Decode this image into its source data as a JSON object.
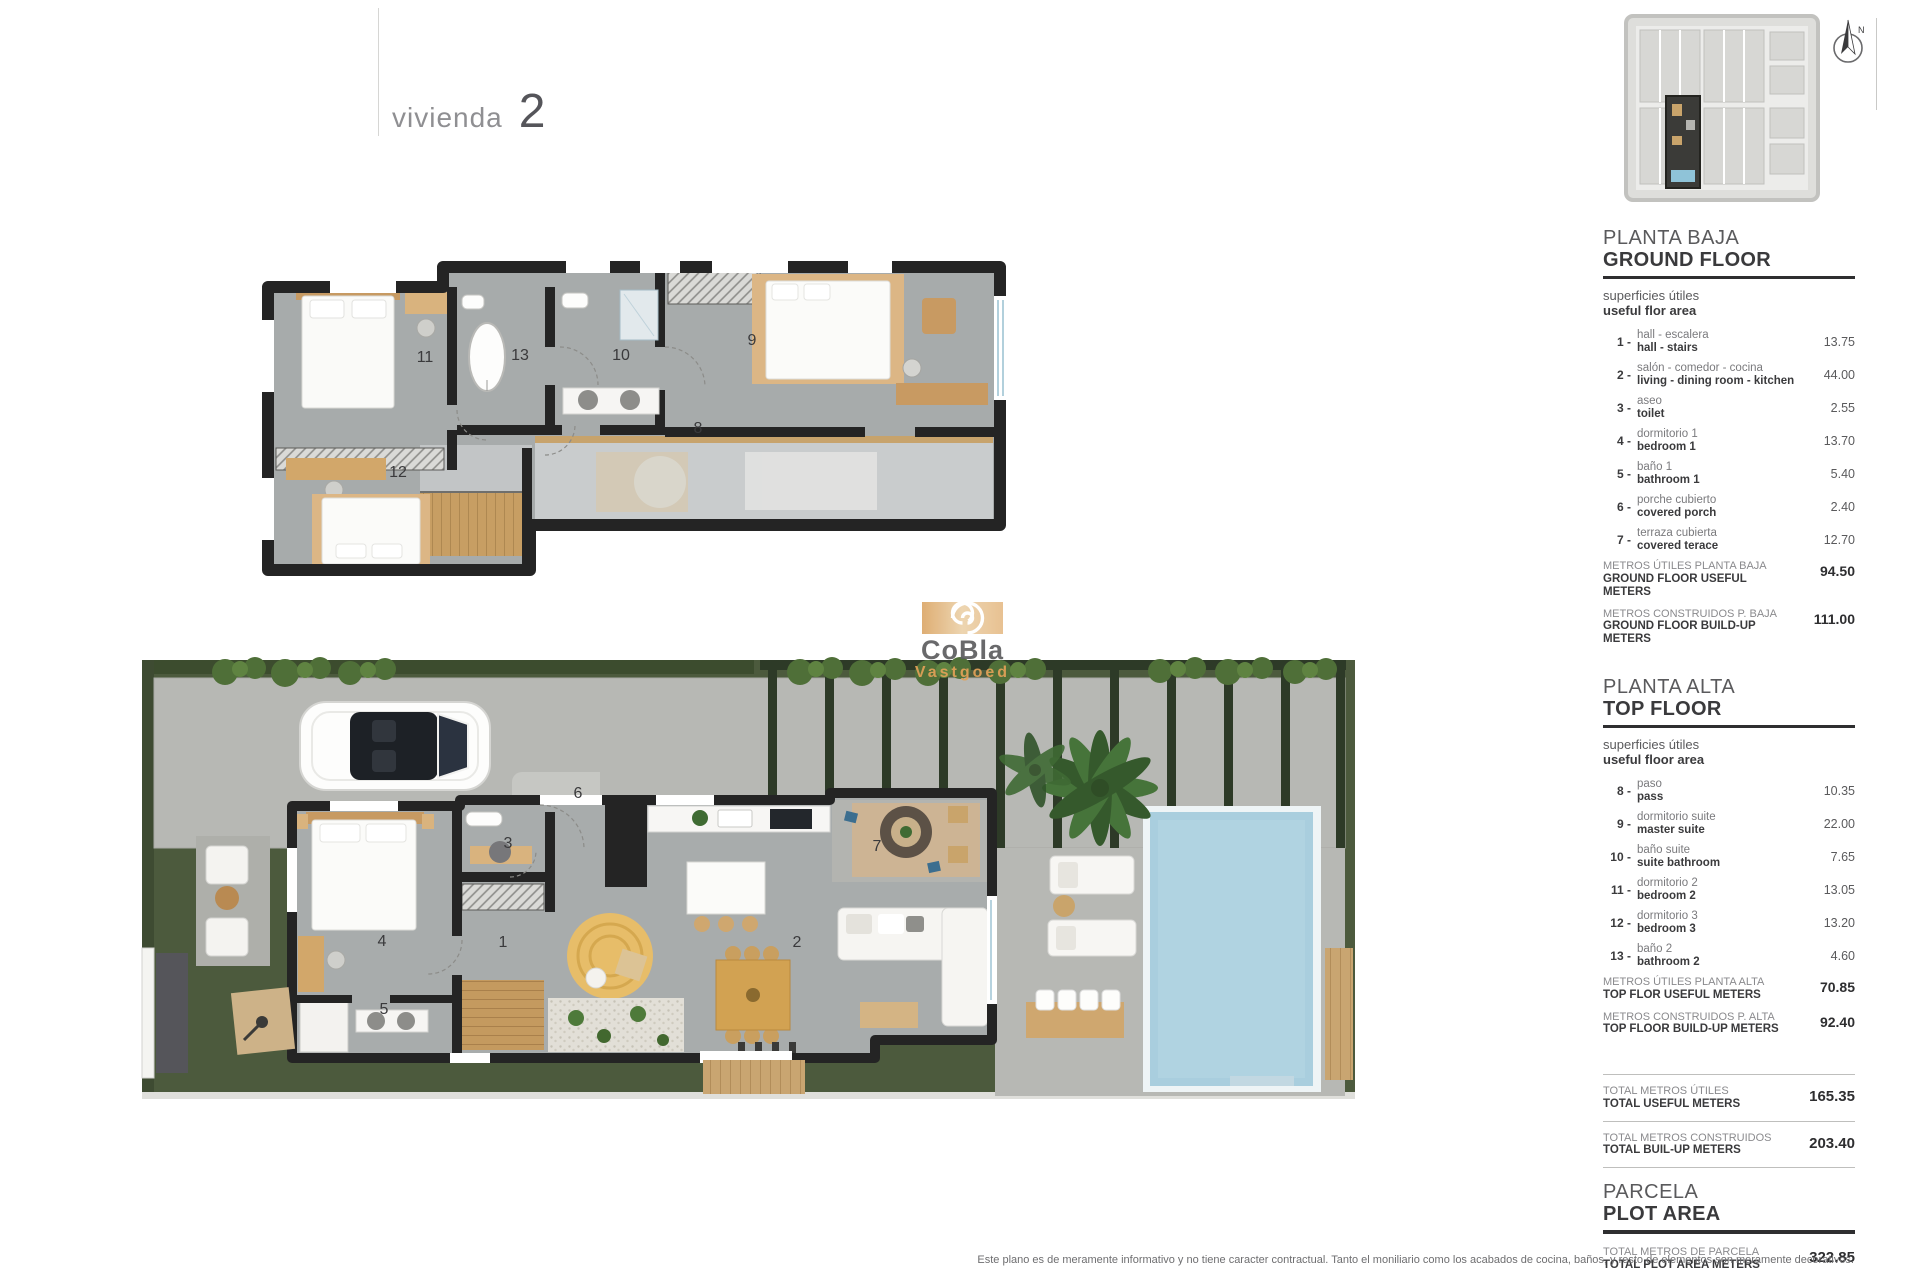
{
  "page": {
    "title_label": "vivienda",
    "title_number": "2"
  },
  "compass": {
    "label": "N"
  },
  "watermark": {
    "line1": "CoBla",
    "line2": "Vastgoed"
  },
  "legend": {
    "ground": {
      "title_es": "PLANTA BAJA",
      "title_en": "GROUND FLOOR",
      "subtitle_es": "superficies útiles",
      "subtitle_en": "useful flor area",
      "items": [
        {
          "n": "1",
          "es": "hall - escalera",
          "en": "hall - stairs",
          "value": "13.75"
        },
        {
          "n": "2",
          "es": "salón - comedor - cocina",
          "en": "living - dining room - kitchen",
          "value": "44.00"
        },
        {
          "n": "3",
          "es": "aseo",
          "en": "toilet",
          "value": "2.55"
        },
        {
          "n": "4",
          "es": "dormitorio 1",
          "en": "bedroom 1",
          "value": "13.70"
        },
        {
          "n": "5",
          "es": "baño 1",
          "en": "bathroom 1",
          "value": "5.40"
        },
        {
          "n": "6",
          "es": "porche cubierto",
          "en": "covered porch",
          "value": "2.40"
        },
        {
          "n": "7",
          "es": "terraza cubierta",
          "en": "covered terace",
          "value": "12.70"
        }
      ],
      "useful_es": "METROS ÚTILES PLANTA BAJA",
      "useful_en": "GROUND FLOOR USEFUL METERS",
      "useful_value": "94.50",
      "built_es": "METROS CONSTRUIDOS P. BAJA",
      "built_en": "GROUND FLOOR BUILD-UP METERS",
      "built_value": "111.00"
    },
    "top": {
      "title_es": "PLANTA ALTA",
      "title_en": "TOP FLOOR",
      "subtitle_es": "superficies útiles",
      "subtitle_en": "useful floor area",
      "items": [
        {
          "n": "8",
          "es": "paso",
          "en": "pass",
          "value": "10.35"
        },
        {
          "n": "9",
          "es": "dormitorio suite",
          "en": "master suite",
          "value": "22.00"
        },
        {
          "n": "10",
          "es": "baño suite",
          "en": "suite bathroom",
          "value": "7.65"
        },
        {
          "n": "11",
          "es": "dormitorio 2",
          "en": "bedroom 2",
          "value": "13.05"
        },
        {
          "n": "12",
          "es": "dormitorio 3",
          "en": "bedroom 3",
          "value": "13.20"
        },
        {
          "n": "13",
          "es": "baño 2",
          "en": "bathroom 2",
          "value": "4.60"
        }
      ],
      "useful_es": "METROS ÚTILES PLANTA ALTA",
      "useful_en": "TOP FLOR USEFUL METERS",
      "useful_value": "70.85",
      "built_es": "METROS CONSTRUIDOS P. ALTA",
      "built_en": "TOP FLOOR BUILD-UP METERS",
      "built_value": "92.40"
    },
    "totals": {
      "useful_es": "TOTAL METROS ÚTILES",
      "useful_en": "TOTAL USEFUL METERS",
      "useful_value": "165.35",
      "built_es": "TOTAL METROS CONSTRUIDOS",
      "built_en": "TOTAL BUIL-UP METERS",
      "built_value": "203.40"
    },
    "plot": {
      "title_es": "PARCELA",
      "title_en": "PLOT AREA",
      "total_es": "TOTAL METROS DE PARCELA",
      "total_en": "TOTAL PLOT AREA METERS",
      "total_value": "322.85",
      "parking_n": "P",
      "parking_es": "parking cubierto",
      "parking_en": "carport",
      "parking_value": "32.15"
    }
  },
  "plans": {
    "top_floor_rooms": {
      "r8": "8",
      "r9": "9",
      "r10": "10",
      "r11": "11",
      "r12": "12",
      "r13": "13"
    },
    "ground_floor_rooms": {
      "r1": "1",
      "r2": "2",
      "r3": "3",
      "r4": "4",
      "r5": "5",
      "r6": "6",
      "r7": "7"
    }
  },
  "disclaimer": "Este plano es de meramente informativo y no tiene caracter contractual. Tanto el moniliario como los acabados de cocina, baños, y resto de elementos son meramente decorativos."
}
